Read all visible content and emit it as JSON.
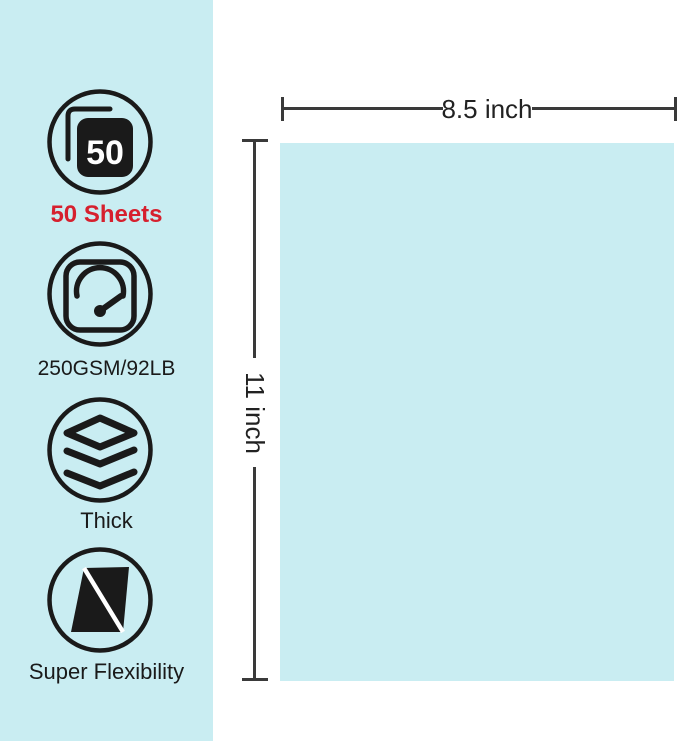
{
  "colors": {
    "panel_bg": "#c9edf2",
    "paper_bg": "#c9edf2",
    "accent_red": "#d6202e",
    "line": "#3a3a3a",
    "icon": "#1a1a1a",
    "text": "#222222"
  },
  "sidebar": {
    "features": [
      {
        "icon": "sheets-count-icon",
        "badge": "50",
        "label": "50 Sheets"
      },
      {
        "icon": "gauge-icon",
        "label": "250GSM/92LB"
      },
      {
        "icon": "layers-icon",
        "label": "Thick"
      },
      {
        "icon": "flexibility-icon",
        "label": "Super Flexibility"
      }
    ]
  },
  "diagram": {
    "paper_width_label": "8.5 inch",
    "paper_height_label": "11 inch"
  }
}
